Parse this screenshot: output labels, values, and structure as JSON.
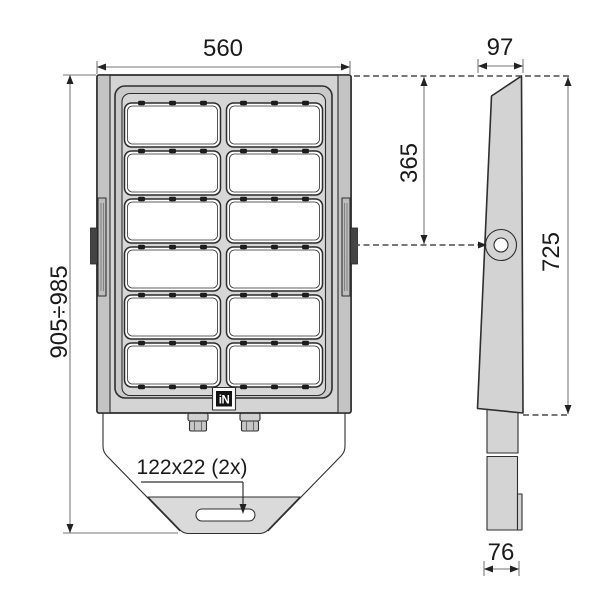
{
  "logo_badge": {
    "text": "iN"
  },
  "dimensions": {
    "front_width": "560",
    "overall_height": "905÷985",
    "top_depth": "97",
    "pivot_from_top": "365",
    "body_height": "725",
    "mount_slot": "122x22 (2x)",
    "bottom_depth": "76"
  },
  "front_view": {
    "grid": {
      "rows": 6,
      "cols": 2
    }
  },
  "colors": {
    "background": "#ffffff",
    "outline": "#2e2e2e",
    "dimension_line": "#8f8f8f",
    "housing_fill": "#d4d4d4",
    "module_fill": "#ffffff"
  }
}
